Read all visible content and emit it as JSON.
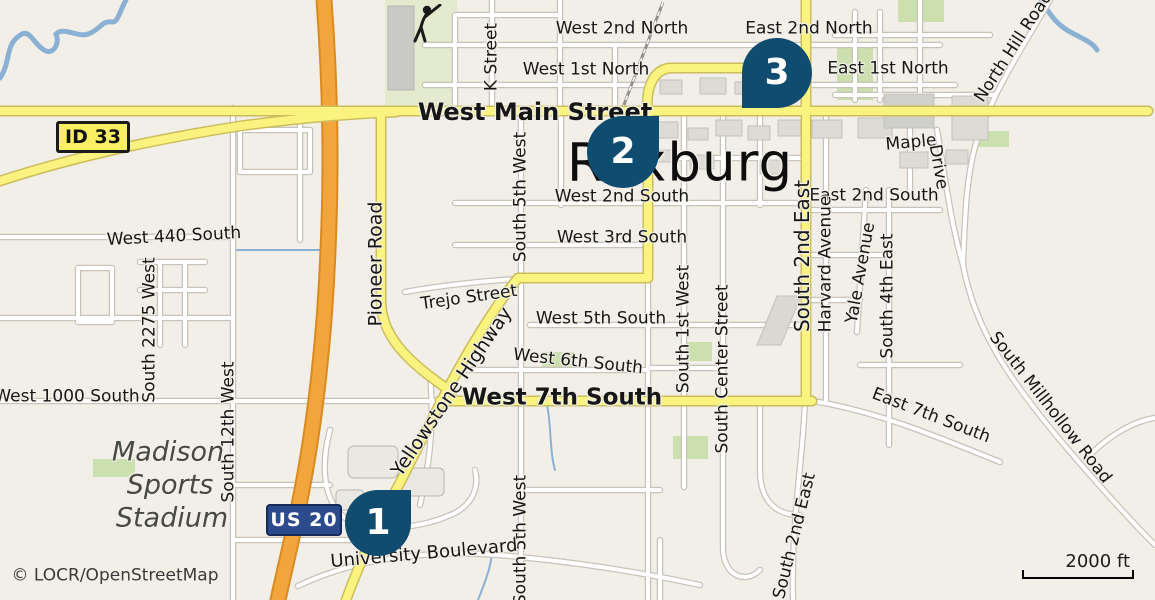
{
  "map": {
    "city_label": "Rexburg",
    "attribution": "© LOCR/OpenStreetMap",
    "scale": {
      "label": "2000 ft"
    },
    "shields": [
      {
        "id": "id33",
        "label": "ID 33",
        "color": "#F8EF62"
      },
      {
        "id": "us20",
        "label": "US 20",
        "color": "#2C4B8D"
      }
    ],
    "markers": [
      {
        "number": "1"
      },
      {
        "number": "2"
      },
      {
        "number": "3"
      }
    ],
    "colors": {
      "land": "#F2EFE8",
      "road_yellow": "#FBF37F",
      "road_orange": "#F2A53C",
      "water": "#8AB1D4",
      "marker": "#0F4C70",
      "park_green": "#CBDFAF"
    },
    "labels": [
      {
        "text": "West 2nd North"
      },
      {
        "text": "East 2nd North"
      },
      {
        "text": "West 1st North"
      },
      {
        "text": "East 1st North"
      },
      {
        "text": "West Main Street"
      },
      {
        "text": "West 2nd South"
      },
      {
        "text": "East 2nd South"
      },
      {
        "text": "West 3rd South"
      },
      {
        "text": "Maple"
      },
      {
        "text": "Drive"
      },
      {
        "text": "West 440 South"
      },
      {
        "text": "Trejo Street"
      },
      {
        "text": "West 5th South"
      },
      {
        "text": "West 6th South"
      },
      {
        "text": "West 7th South"
      },
      {
        "text": "East 7th South"
      },
      {
        "text": "West 1000 South"
      },
      {
        "text": "K Street"
      },
      {
        "text": "South 5th West"
      },
      {
        "text": "Pioneer Road"
      },
      {
        "text": "South 2275 West"
      },
      {
        "text": "South 12th West"
      },
      {
        "text": "South 1st West"
      },
      {
        "text": "South Center Street"
      },
      {
        "text": "South 2nd East"
      },
      {
        "text": "Harvard Avenue"
      },
      {
        "text": "Yale Avenue"
      },
      {
        "text": "South 4th East"
      },
      {
        "text": "South 5th West"
      },
      {
        "text": "South 2nd East"
      },
      {
        "text": "Yellowstone Highway"
      },
      {
        "text": "University Boulevard"
      },
      {
        "text": "North Hill Road"
      },
      {
        "text": "South Millhollow Road"
      },
      {
        "text": "Madison"
      },
      {
        "text": "Sports"
      },
      {
        "text": "Stadium"
      }
    ]
  }
}
